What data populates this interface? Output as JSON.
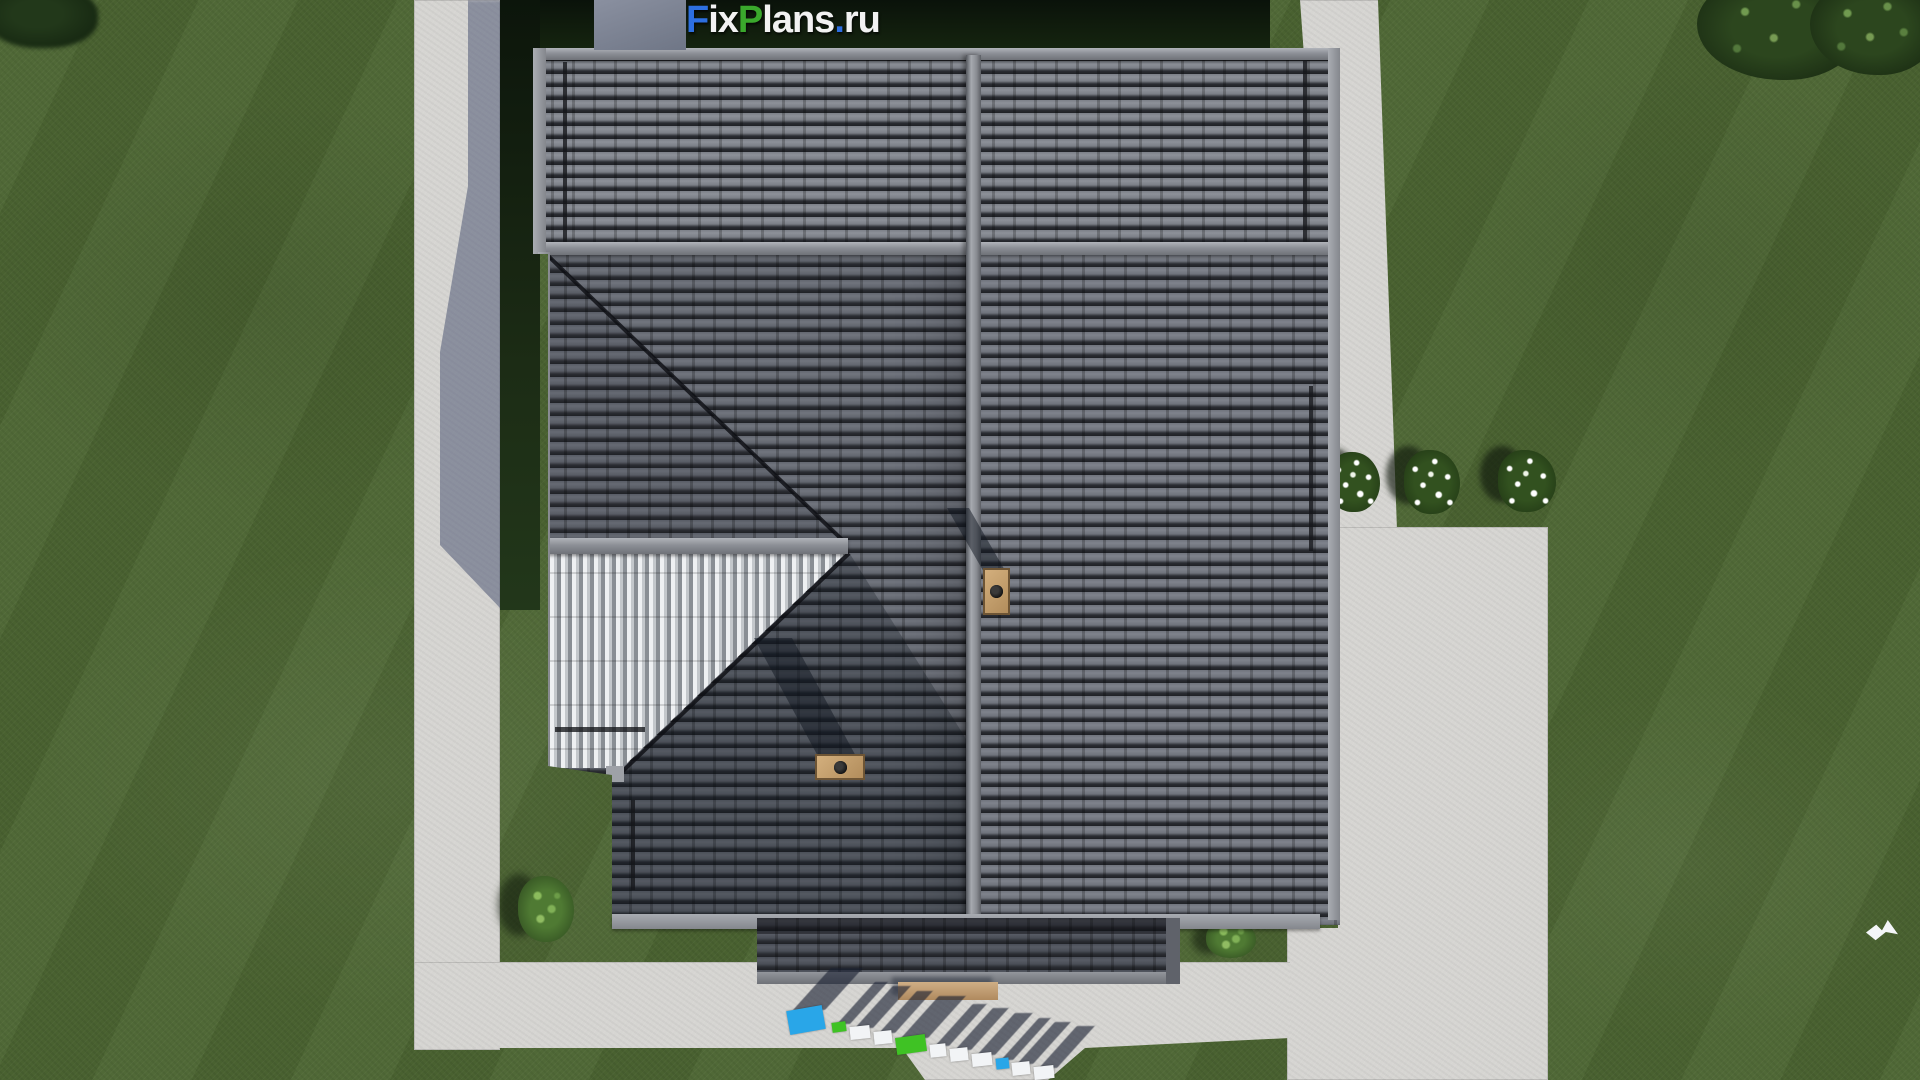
{
  "watermark_top": {
    "text": "FixPlans.ru",
    "parts": [
      {
        "text": "F",
        "color": "#2d6fe0"
      },
      {
        "text": "ix",
        "color": "#f2f2f2"
      },
      {
        "text": "P",
        "color": "#3aa82c"
      },
      {
        "text": "lans",
        "color": "#f2f2f2"
      },
      {
        "text": ".",
        "color": "#2d6fe0"
      },
      {
        "text": "ru",
        "color": "#f2f2f2"
      }
    ]
  },
  "watermark_ground": {
    "text": "FixPlans.ru",
    "blocks": [
      {
        "x": 788,
        "y": 1008,
        "w": 36,
        "h": 24,
        "color": "#29a6e8",
        "rot": -10
      },
      {
        "x": 832,
        "y": 1022,
        "w": 14,
        "h": 10,
        "color": "#3fc224",
        "rot": -8
      },
      {
        "x": 850,
        "y": 1026,
        "w": 20,
        "h": 13,
        "color": "#f2f4f6",
        "rot": -6
      },
      {
        "x": 874,
        "y": 1031,
        "w": 18,
        "h": 13,
        "color": "#f2f4f6",
        "rot": -6
      },
      {
        "x": 896,
        "y": 1036,
        "w": 30,
        "h": 17,
        "color": "#3fc224",
        "rot": -8
      },
      {
        "x": 930,
        "y": 1044,
        "w": 16,
        "h": 13,
        "color": "#f2f4f6",
        "rot": -6
      },
      {
        "x": 950,
        "y": 1048,
        "w": 18,
        "h": 13,
        "color": "#f2f4f6",
        "rot": -6
      },
      {
        "x": 972,
        "y": 1053,
        "w": 20,
        "h": 13,
        "color": "#f2f4f6",
        "rot": -6
      },
      {
        "x": 996,
        "y": 1058,
        "w": 13,
        "h": 11,
        "color": "#29a6e8",
        "rot": -6
      },
      {
        "x": 1012,
        "y": 1062,
        "w": 18,
        "h": 13,
        "color": "#f2f4f6",
        "rot": -6
      },
      {
        "x": 1034,
        "y": 1066,
        "w": 20,
        "h": 13,
        "color": "#f2f4f6",
        "rot": -6
      }
    ]
  },
  "palette": {
    "grass": "#4c6532",
    "concrete": "#d6d5d2",
    "shadow-blue": "rgba(70,80,112,0.52)",
    "roof-dark": "#4a4e57",
    "roof-light": "#7b7f87",
    "ridge": "#9b9ea5",
    "chimney": "#c49a6a",
    "hedge": "#101d0d"
  },
  "scene": {
    "view": "top-down aerial render of a house with dark tiled hip roof",
    "roof_features": [
      "main vertical ridge",
      "two ridge caps",
      "hip with bright corrugated west slope",
      "porch roof",
      "two tan chimneys with round flues",
      "snow guard rails"
    ],
    "ground_features": [
      "lawn",
      "L-shaped concrete walkway",
      "right-side concrete patio",
      "hedge band at top",
      "two trees top-right",
      "tree top-left"
    ],
    "plants": {
      "flower_bush_count": 3,
      "shrub_count": 2
    },
    "bird_visible": true,
    "bench_visible": true
  }
}
